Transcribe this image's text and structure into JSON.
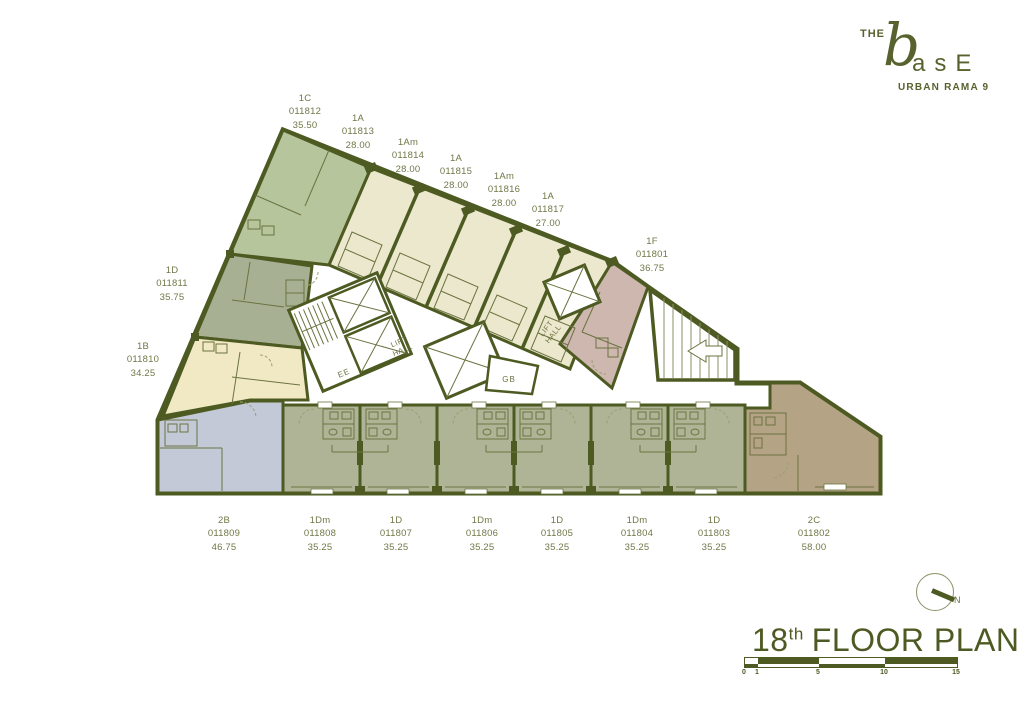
{
  "brand": {
    "the": "THE",
    "base_b": "b",
    "base_rest": "asE",
    "subtitle": "URBAN RAMA 9"
  },
  "title": {
    "number": "18",
    "ordinal": "th",
    "label": "FLOOR PLAN"
  },
  "compass": {
    "north": "N"
  },
  "scalebar": {
    "ticks": [
      "0",
      "1",
      "5",
      "10",
      "15"
    ]
  },
  "core_labels": {
    "lift": "LIFT",
    "hall": "HALL",
    "ee": "EE",
    "gb": "GB"
  },
  "units": [
    {
      "type": "1C",
      "code": "011812",
      "area": "35.50"
    },
    {
      "type": "1A",
      "code": "011813",
      "area": "28.00"
    },
    {
      "type": "1Am",
      "code": "011814",
      "area": "28.00"
    },
    {
      "type": "1A",
      "code": "011815",
      "area": "28.00"
    },
    {
      "type": "1Am",
      "code": "011816",
      "area": "28.00"
    },
    {
      "type": "1A",
      "code": "011817",
      "area": "27.00"
    },
    {
      "type": "1F",
      "code": "011801",
      "area": "36.75"
    },
    {
      "type": "1D",
      "code": "011811",
      "area": "35.75"
    },
    {
      "type": "1B",
      "code": "011810",
      "area": "34.25"
    },
    {
      "type": "2B",
      "code": "011809",
      "area": "46.75"
    },
    {
      "type": "1Dm",
      "code": "011808",
      "area": "35.25"
    },
    {
      "type": "1D",
      "code": "011807",
      "area": "35.25"
    },
    {
      "type": "1Dm",
      "code": "011806",
      "area": "35.25"
    },
    {
      "type": "1D",
      "code": "011805",
      "area": "35.25"
    },
    {
      "type": "1Dm",
      "code": "011804",
      "area": "35.25"
    },
    {
      "type": "1D",
      "code": "011803",
      "area": "35.25"
    },
    {
      "type": "2C",
      "code": "011802",
      "area": "58.00"
    }
  ],
  "colors": {
    "wall": "#4d5a22",
    "accent": "#57622e",
    "label_text": "#6f7847",
    "unit_1c": "#b7c59c",
    "unit_1a": "#ece8cd",
    "unit_1f": "#cdb7af",
    "unit_1d_left": "#a8b094",
    "unit_1b": "#f0e9c3",
    "unit_2b": "#c4c9d7",
    "unit_bottom": "#b0b496",
    "unit_2c": "#b5a386"
  }
}
